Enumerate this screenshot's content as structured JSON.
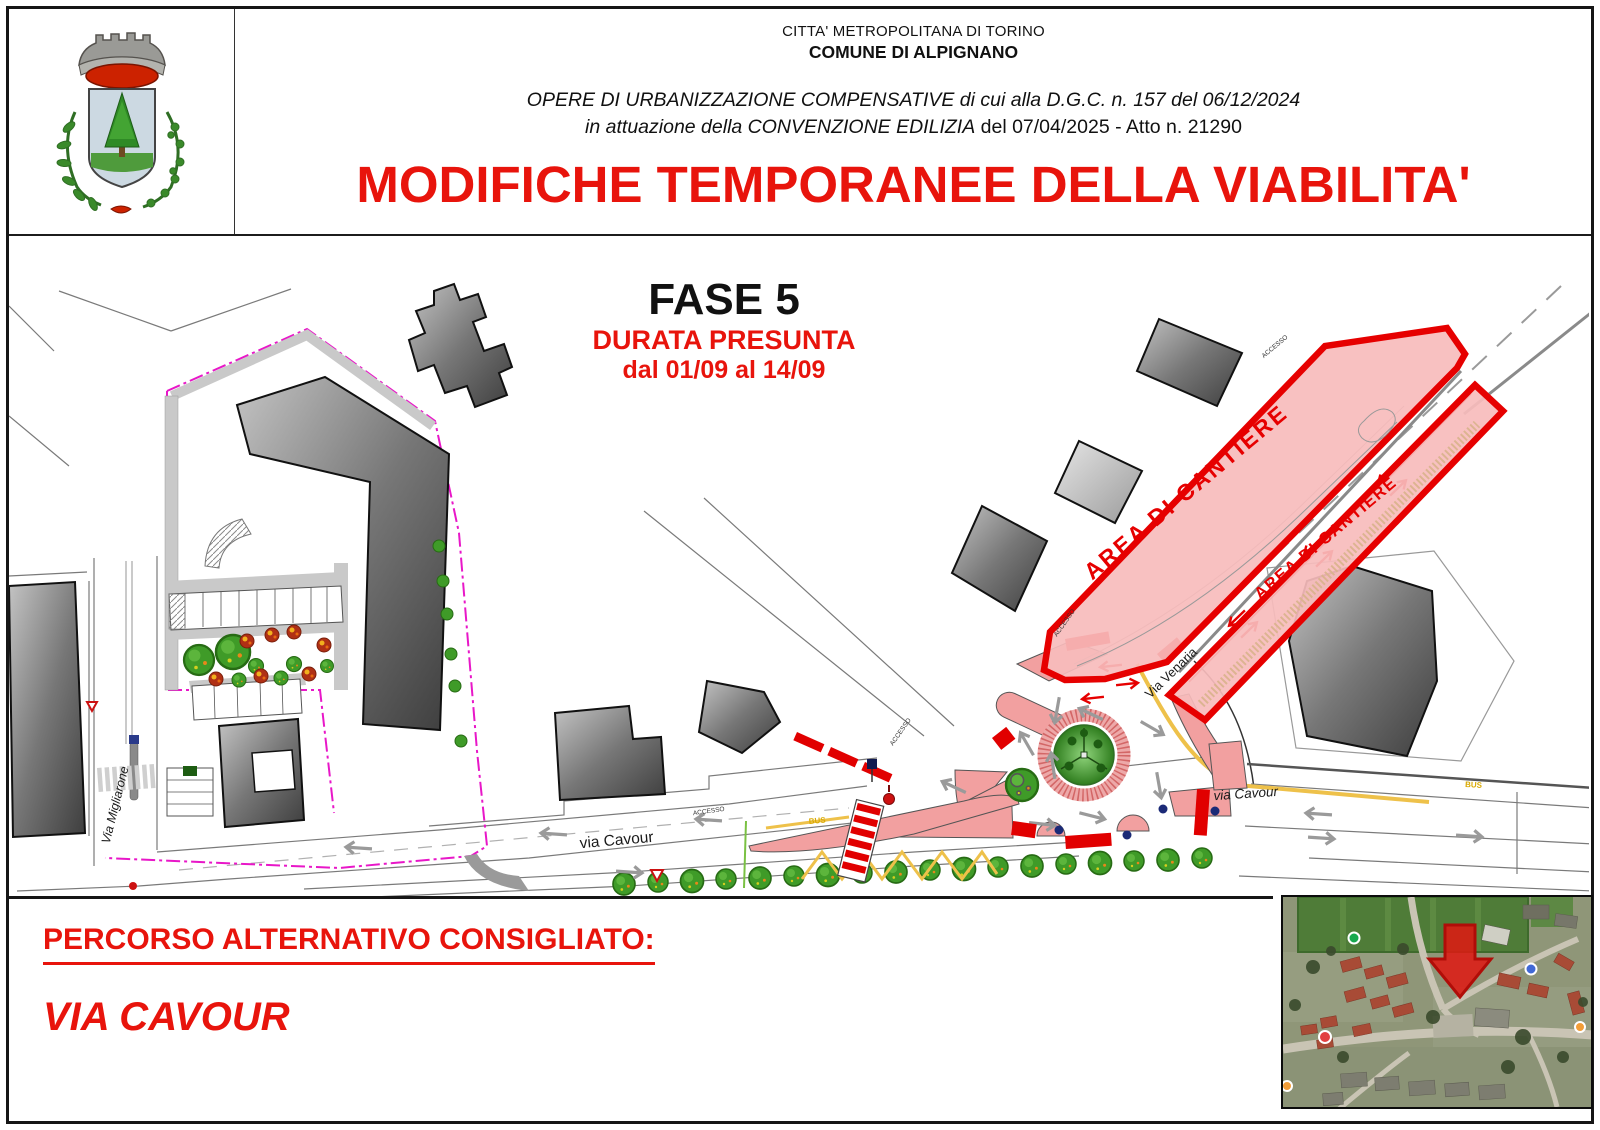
{
  "header": {
    "authority": "CITTA' METROPOLITANA DI TORINO",
    "municipality": "COMUNE DI ALPIGNANO",
    "works_line": "OPERE DI URBANIZZAZIONE COMPENSATIVE di cui alla D.G.C. n. 157 del 06/12/2024",
    "convention_line_italic": "in attuazione della CONVENZIONE EDILIZIA",
    "convention_line_regular": "del 07/04/2025 - Atto n. 21290",
    "title": "MODIFICHE TEMPORANEE DELLA VIABILITA'"
  },
  "phase": {
    "name": "FASE 5",
    "duration_label": "DURATA PRESUNTA",
    "duration_dates": "dal 01/09 al 14/09"
  },
  "map": {
    "labels": {
      "area_cantiere": "AREA DI CANTIERE",
      "via_venaria": "Via Venaria",
      "via_cavour": "via Cavour",
      "via_migliarone": "Via Migliarone",
      "accesso": "ACCESSO",
      "bus": "BUS"
    }
  },
  "footer": {
    "alt_route_label": "PERCORSO ALTERNATIVO CONSIGLIATO:",
    "alt_route_value": "VIA CAVOUR"
  },
  "colors": {
    "red": "#e60000",
    "title_red": "#e8140c",
    "cantiere_fill": "#f7bcbc",
    "island_pink": "#f2a0a0",
    "boundary_magenta": "#e817c8",
    "lane_yellow": "#eec14a",
    "tree_green": "#3f9b28"
  }
}
